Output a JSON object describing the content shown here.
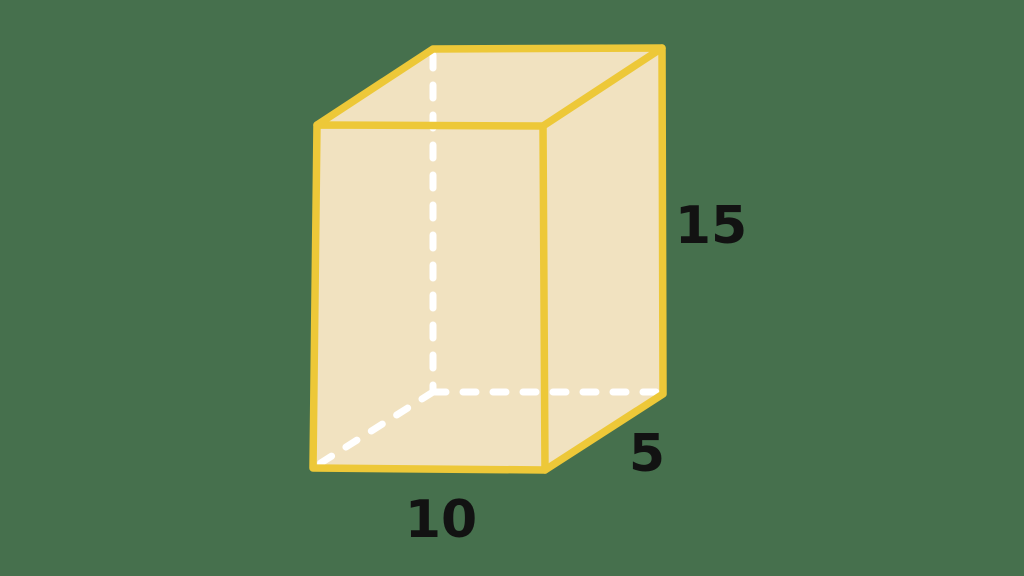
{
  "scene": {
    "background_color": "#46704D",
    "description": "Rectangular prism (cuboid) geometry diagram"
  },
  "prism": {
    "fill_color": "#F1E2C0",
    "edge_color": "#EDC838",
    "hidden_edge_color": "#FFFFFF",
    "label_color": "#121212",
    "labels": {
      "height": "15",
      "depth": "5",
      "width": "10"
    },
    "dimensions": {
      "width_value": 10,
      "depth_value": 5,
      "height_value": 15
    }
  }
}
